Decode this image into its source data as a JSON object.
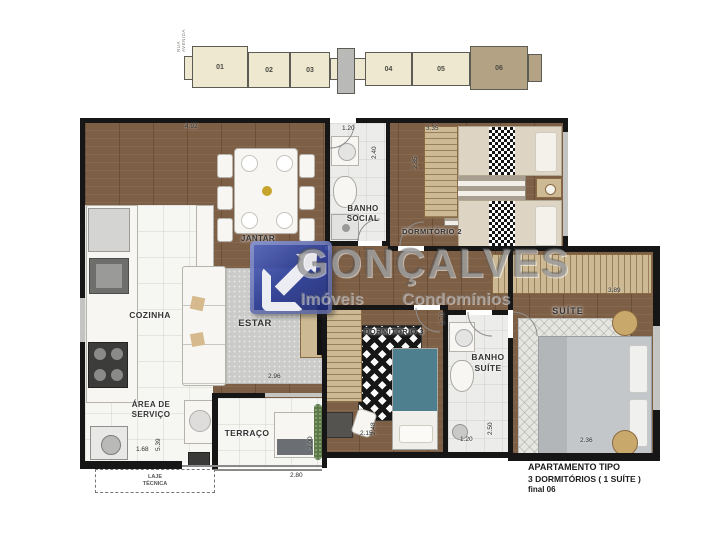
{
  "key_plan": {
    "street_label": "RUA AVENIDA",
    "units": [
      {
        "num": "01",
        "highlighted": false
      },
      {
        "num": "02",
        "highlighted": false
      },
      {
        "num": "03",
        "highlighted": false
      },
      {
        "num": "04",
        "highlighted": false
      },
      {
        "num": "05",
        "highlighted": false
      },
      {
        "num": "06",
        "highlighted": true
      }
    ],
    "unit_fill": "#efe8d0",
    "highlight_fill": "#b3a284"
  },
  "watermark": {
    "brand": "GONÇALVES",
    "tagline_left": "Imóveis",
    "tagline_right": "Condomínios",
    "logo_color": "#2e3f8f"
  },
  "rooms": {
    "jantar": {
      "label": "JANTAR"
    },
    "estar": {
      "label": "ESTAR"
    },
    "cozinha": {
      "label": "COZINHA"
    },
    "area_servico": {
      "label": "ÁREA DE\nSERVIÇO"
    },
    "terraco": {
      "label": "TERRAÇO"
    },
    "laje_tecnica": {
      "label": "LAJE\nTÉCNICA"
    },
    "banho_social": {
      "label": "BANHO\nSOCIAL"
    },
    "dormitorio_2": {
      "label": "DORMITÓRIO 2"
    },
    "dormitorio_3": {
      "label": "DORMITÓRIO 3"
    },
    "banho_suite": {
      "label": "BANHO\nSUÍTE"
    },
    "suite": {
      "label": "SUÍTE"
    }
  },
  "dimensions": [
    {
      "value": "4.92",
      "x": 185,
      "y": 123,
      "vertical": false
    },
    {
      "value": "1.20",
      "x": 342,
      "y": 125,
      "vertical": false
    },
    {
      "value": "2.40",
      "x": 378,
      "y": 152,
      "vertical": true
    },
    {
      "value": "3.35",
      "x": 426,
      "y": 125,
      "vertical": false
    },
    {
      "value": "2.85",
      "x": 419,
      "y": 162,
      "vertical": true
    },
    {
      "value": "3.89",
      "x": 608,
      "y": 287,
      "vertical": false
    },
    {
      "value": "1.70",
      "x": 446,
      "y": 318,
      "vertical": true
    },
    {
      "value": "2.36",
      "x": 580,
      "y": 437,
      "vertical": false
    },
    {
      "value": "2.15",
      "x": 360,
      "y": 430,
      "vertical": false
    },
    {
      "value": "2.48",
      "x": 377,
      "y": 428,
      "vertical": true
    },
    {
      "value": "1.20",
      "x": 460,
      "y": 436,
      "vertical": false
    },
    {
      "value": "2.50",
      "x": 494,
      "y": 428,
      "vertical": true
    },
    {
      "value": "2.80",
      "x": 290,
      "y": 472,
      "vertical": false
    },
    {
      "value": "2.00",
      "x": 314,
      "y": 442,
      "vertical": true
    },
    {
      "value": "1.68",
      "x": 136,
      "y": 446,
      "vertical": false
    },
    {
      "value": "5.39",
      "x": 162,
      "y": 444,
      "vertical": true
    },
    {
      "value": "2.96",
      "x": 268,
      "y": 373,
      "vertical": false
    }
  ],
  "title_block": {
    "line1": "APARTAMENTO  TIPO",
    "line2": "3 DORMITÓRIOS ( 1 SUÍTE )",
    "line3": "final 06"
  },
  "colors": {
    "wall": "#161616",
    "wood_floor": "#7d5f46",
    "tile_floor": "#f6f6f3",
    "wardrobe_tan": "#cdba94",
    "bed_teal": "#4e7f8e",
    "logo_blue": "#2e3f8f",
    "watermark_gray": "#767676"
  }
}
